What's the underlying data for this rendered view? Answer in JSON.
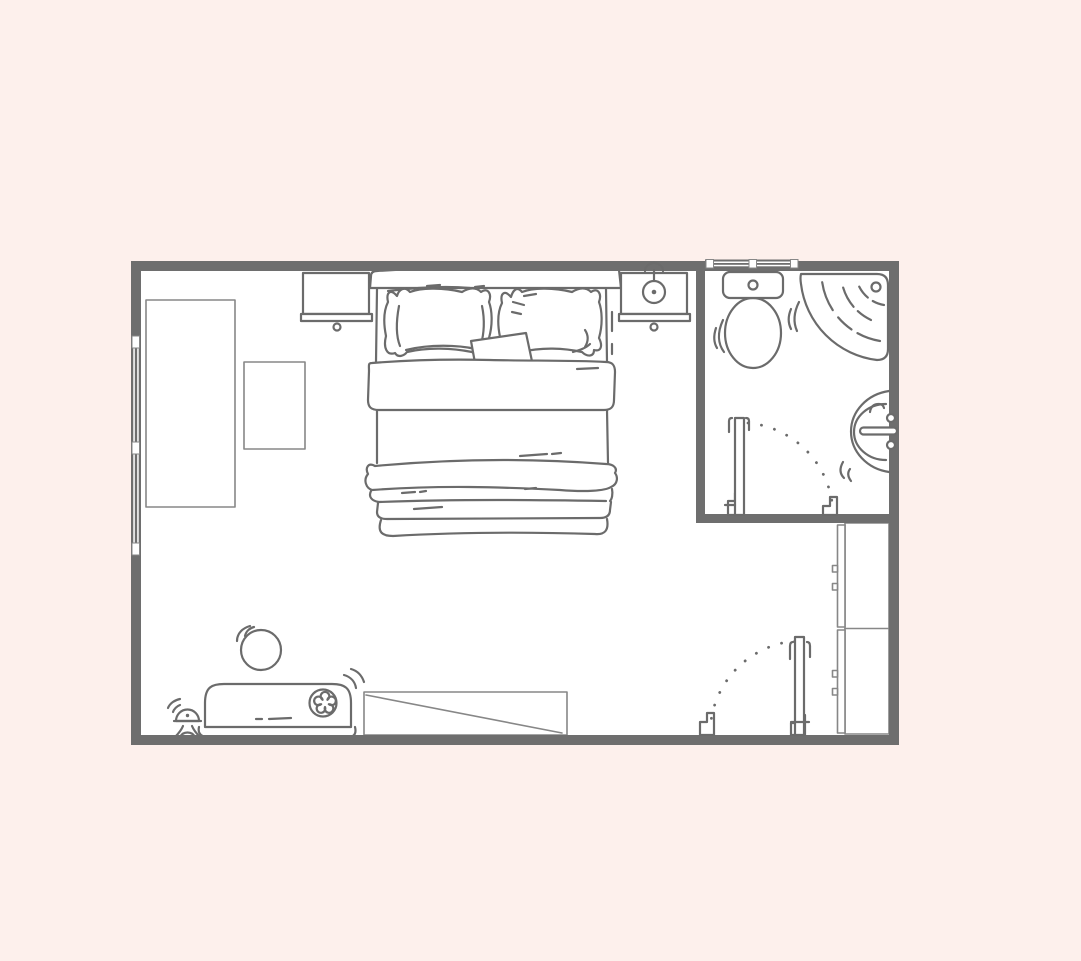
{
  "colors": {
    "background": "#fdf0ec",
    "wall": "#6e6e6e",
    "line": "#6b6b6b",
    "line_light": "#878787",
    "floor": "#ffffff",
    "window_pane": "#ffffff"
  },
  "plan": {
    "type": "floor-plan",
    "rooms": [
      "bedroom",
      "ensuite-bathroom"
    ],
    "labels": {
      "canvas": "bedroom floor plan",
      "bedroom": "bedroom",
      "bathroom": "bathroom",
      "bed": "double bed",
      "headboard": "headboard",
      "pillow_left": "pillow",
      "pillow_right": "pillow",
      "cushion": "throw cushion",
      "nightstand_left": "nightstand",
      "nightstand_right": "nightstand with lamp",
      "table_lamp": "table lamp",
      "wardrobe": "wardrobe",
      "side_table": "side table",
      "toilet": "toilet",
      "shower": "corner shower",
      "sink": "wall-mounted sink",
      "closet": "built-in closet",
      "bench": "bench sofa with flower cushion",
      "stool": "round stool",
      "mini_lamp": "small floor lamp",
      "console": "low console",
      "door_main": "entrance door",
      "door_bath": "bathroom door",
      "window_left": "window",
      "window_bath": "window"
    }
  }
}
